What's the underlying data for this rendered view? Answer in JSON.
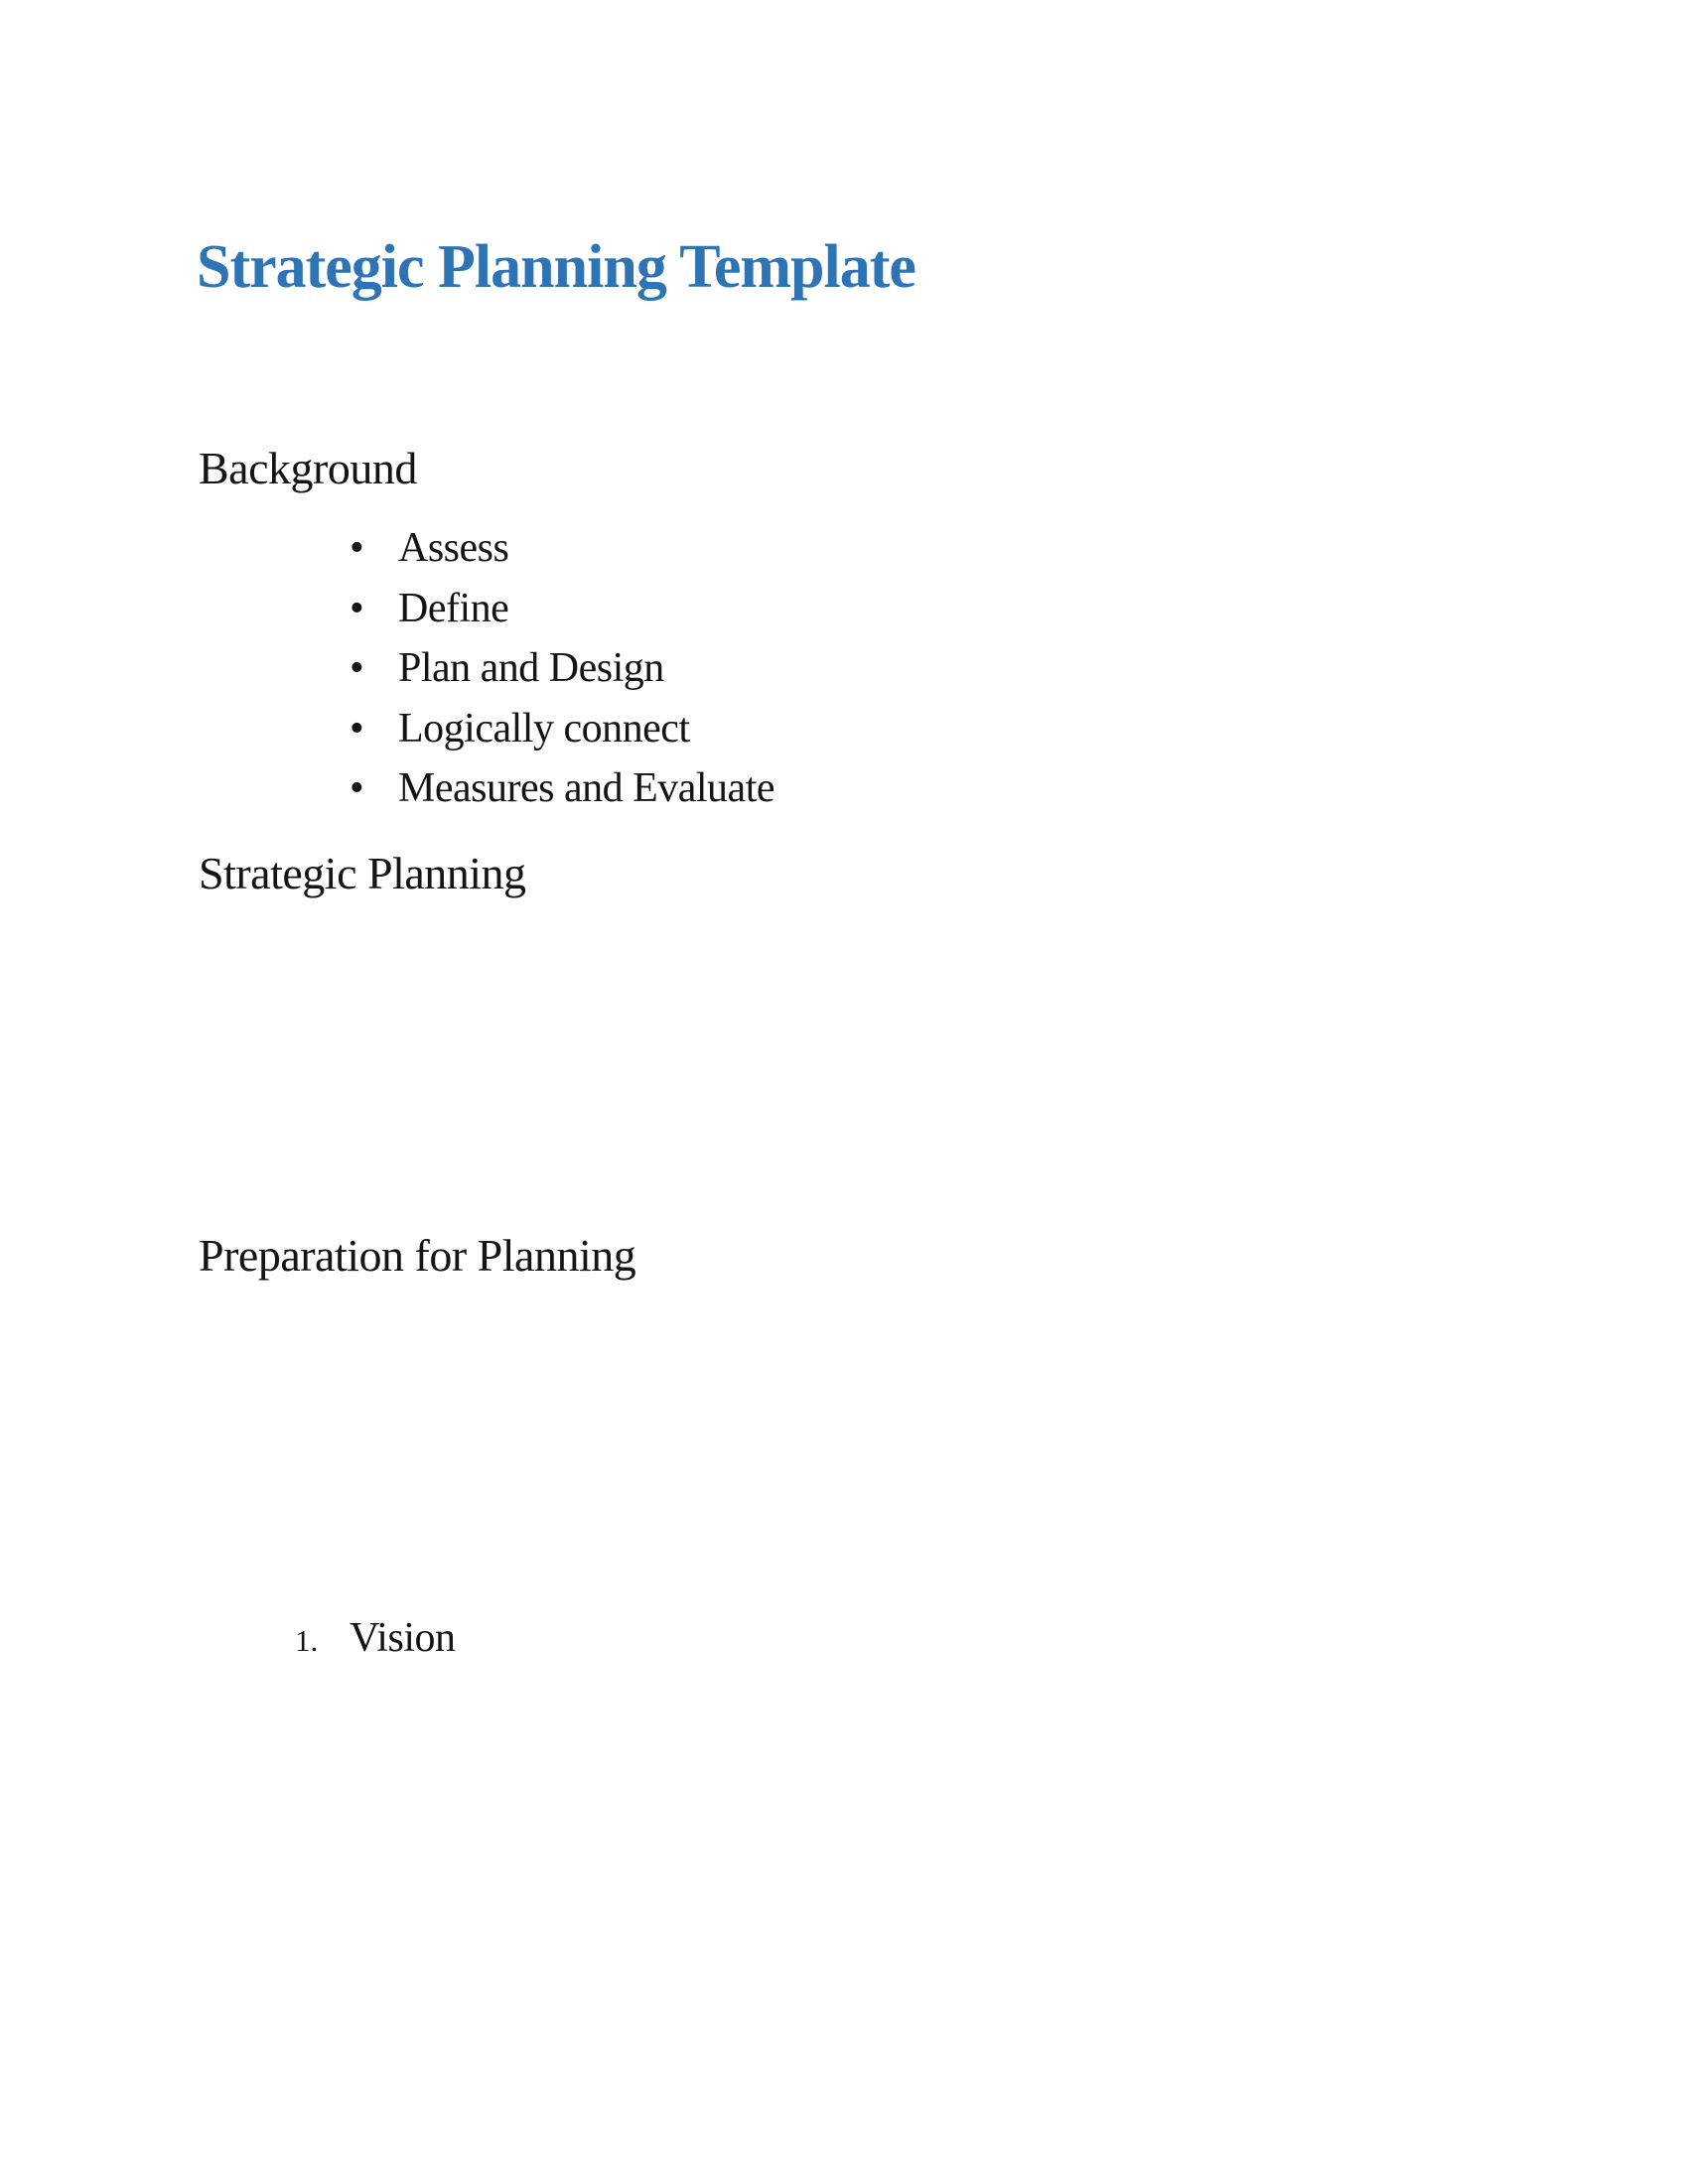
{
  "doc": {
    "title": "Strategic Planning Template",
    "bullet_char": "•",
    "background": {
      "heading": "Background",
      "bullets": [
        "Assess",
        "Define",
        "Plan and Design",
        "Logically connect",
        "Measures and Evaluate"
      ]
    },
    "strategic_planning": {
      "heading": "Strategic Planning"
    },
    "preparation": {
      "heading": "Preparation for Planning",
      "numbered_items": [
        {
          "number": "1.",
          "label": "Vision"
        }
      ]
    },
    "colors": {
      "title_blue": "#2E74B5",
      "body_text": "#141414",
      "page_background": "#FFFFFF"
    }
  }
}
